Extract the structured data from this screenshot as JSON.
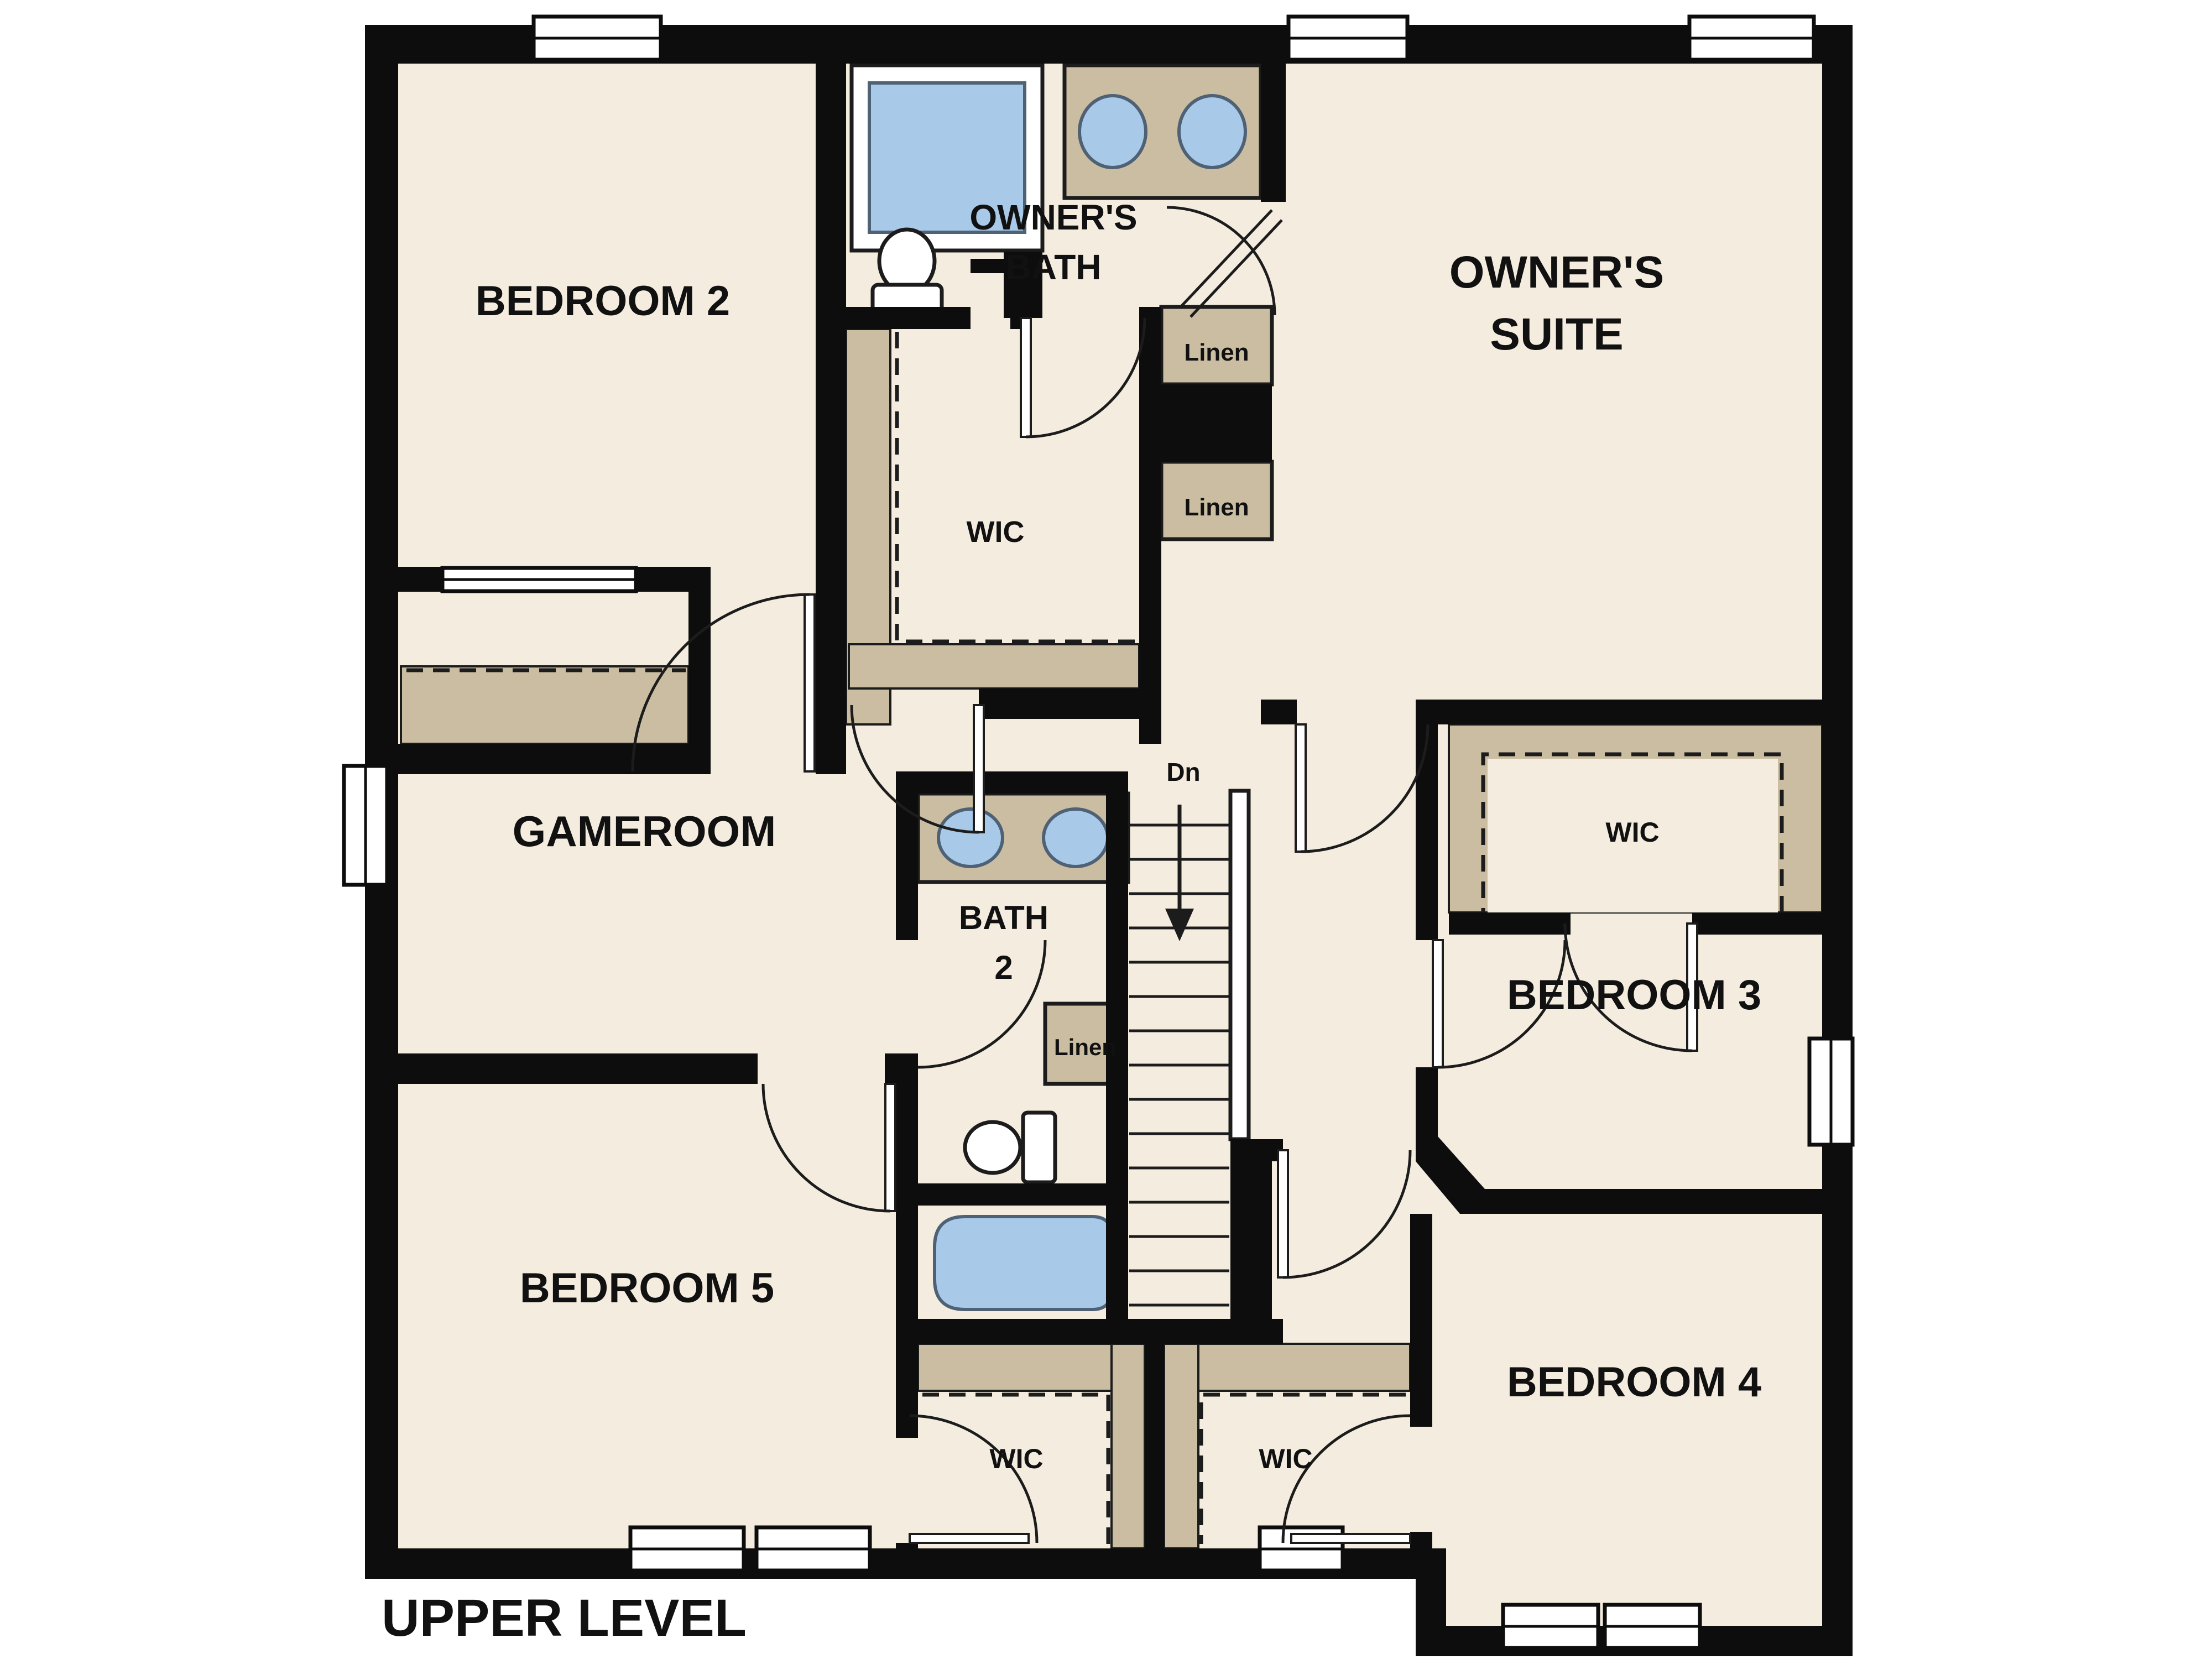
{
  "level_title": "UPPER LEVEL",
  "palette": {
    "background": "#ffffff",
    "floor": "#f4ecdf",
    "wall": "#0d0d0d",
    "closet_tan": "#cabda1",
    "fixture_blue": "#a9c9e9",
    "fixture_stroke": "#4e6175",
    "line": "#1c1c1c",
    "text": "#111111"
  },
  "labels": {
    "bedroom2": "BEDROOM 2",
    "owners_bath_line1": "OWNER'S",
    "owners_bath_line2": "BATH",
    "owners_suite_line1": "OWNER'S",
    "owners_suite_line2": "SUITE",
    "gameroom": "GAMEROOM",
    "bath2_line1": "BATH",
    "bath2_line2": "2",
    "bedroom3": "BEDROOM 3",
    "bedroom4": "BEDROOM 4",
    "bedroom5": "BEDROOM 5",
    "wic_owners": "WIC",
    "wic_bedroom3": "WIC",
    "wic_bedroom5": "WIC",
    "wic_bedroom4": "WIC",
    "linen_upper": "Linen",
    "linen_lower": "Linen",
    "linen_bath2": "Linen",
    "stairs_dn": "Dn",
    "level_title": "UPPER LEVEL"
  }
}
